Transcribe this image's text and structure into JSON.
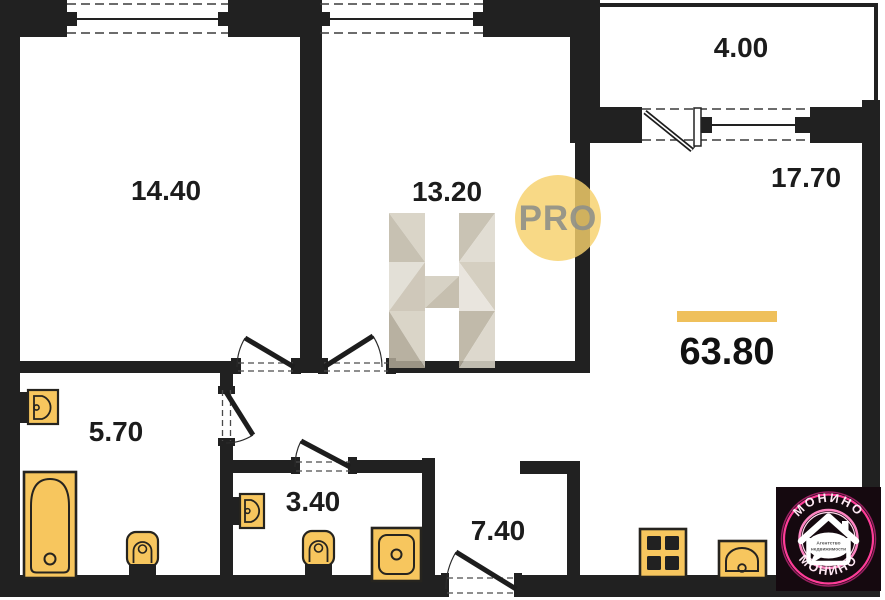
{
  "plan": {
    "total_area": "63.80",
    "rooms": [
      {
        "id": "room-1",
        "area": "14.40"
      },
      {
        "id": "room-2",
        "area": "13.20"
      },
      {
        "id": "loggia",
        "area": "4.00"
      },
      {
        "id": "room-3",
        "area": "17.70"
      },
      {
        "id": "bath-1",
        "area": "5.70"
      },
      {
        "id": "bath-2",
        "area": "3.40"
      },
      {
        "id": "hall",
        "area": "7.40"
      }
    ],
    "colors": {
      "wall": "#212121",
      "fixture": "#f7c65e",
      "accent_bar": "#efc05b",
      "pro_circle": "#f6d16b",
      "logo_pink": "#ff3d98",
      "logo_bg": "#15090f"
    }
  },
  "watermarks": {
    "pro": {
      "label": "PRO"
    }
  },
  "logo": {
    "brand_top": "МОНИНО",
    "brand_bottom": "МОНИНО",
    "tagline_line1": "Агентство",
    "tagline_line2": "недвижимости"
  }
}
